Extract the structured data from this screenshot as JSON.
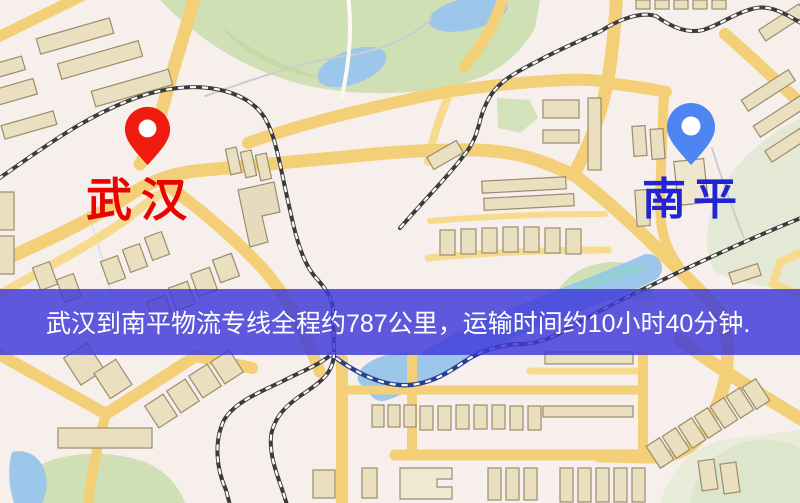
{
  "map": {
    "origin_marker": {
      "label": "武汉",
      "pin_color": "#ee1b0e",
      "label_color": "#ea0400",
      "icon": "map-pin"
    },
    "destination_marker": {
      "label": "南平",
      "pin_color": "#4d86f0",
      "label_color": "#2224d0",
      "icon": "map-pin"
    },
    "info_banner": {
      "text": "武汉到南平物流专线全程约787公里，运输时间约10小时40分钟.",
      "background_color": "#3e3ad8",
      "text_color": "#ffffff"
    },
    "route": {
      "from": "武汉",
      "to": "南平",
      "distance_text": "约787公里",
      "duration_text": "约10小时40分钟"
    },
    "map_colors": {
      "background": "#f5efeb",
      "road": "#f4d078",
      "park": "#cfe0b4",
      "water": "#9cc6ea",
      "building": "#eadfbf",
      "railway": "#3b3b3b"
    }
  }
}
